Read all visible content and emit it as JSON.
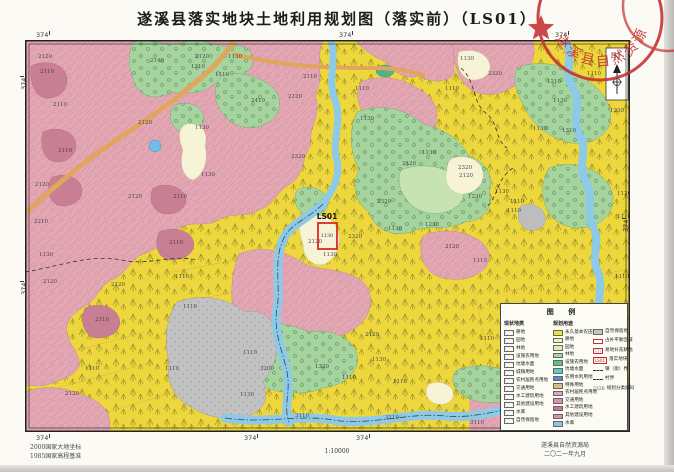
{
  "page": {
    "title": "遂溪县落实地块土地利用规划图（落实前）（LS01）"
  },
  "stamp": {
    "text": "遂溪县自然资源局",
    "color": "#c43030"
  },
  "north_arrow": {
    "label": "N"
  },
  "map": {
    "focus": {
      "label": "LS01",
      "code": "1130",
      "box": {
        "x": 293,
        "y": 183,
        "w": 19,
        "h": 26
      },
      "label_x": 302,
      "label_y": 179,
      "code_x": 302,
      "code_y": 197,
      "color": "#d42a2a"
    },
    "coordinate_labels": [
      {
        "text": "374",
        "x": 36,
        "y": 31,
        "rot": 0
      },
      {
        "text": "374",
        "x": 339,
        "y": 31,
        "rot": 0
      },
      {
        "text": "374",
        "x": 555,
        "y": 31,
        "rot": 0
      },
      {
        "text": "374",
        "x": 36,
        "y": 434,
        "rot": 0
      },
      {
        "text": "374",
        "x": 244,
        "y": 434,
        "rot": 0
      },
      {
        "text": "374",
        "x": 356,
        "y": 434,
        "rot": 0
      },
      {
        "text": "374",
        "x": 20,
        "y": 90,
        "rot": 1
      },
      {
        "text": "374",
        "x": 20,
        "y": 295,
        "rot": 1
      },
      {
        "text": "374",
        "x": 622,
        "y": 232,
        "rot": 1
      }
    ],
    "parcel_labels": [
      {
        "code": "2120",
        "x": 13,
        "y": 18
      },
      {
        "code": "2110",
        "x": 15,
        "y": 33
      },
      {
        "code": "2110",
        "x": 28,
        "y": 66
      },
      {
        "code": "2110",
        "x": 33,
        "y": 112
      },
      {
        "code": "2120",
        "x": 10,
        "y": 146
      },
      {
        "code": "2210",
        "x": 9,
        "y": 183
      },
      {
        "code": "1130",
        "x": 14,
        "y": 216
      },
      {
        "code": "2120",
        "x": 18,
        "y": 243
      },
      {
        "code": "2110",
        "x": 70,
        "y": 281
      },
      {
        "code": "2120",
        "x": 86,
        "y": 246
      },
      {
        "code": "2120",
        "x": 103,
        "y": 158
      },
      {
        "code": "2110",
        "x": 148,
        "y": 158
      },
      {
        "code": "2110",
        "x": 144,
        "y": 204
      },
      {
        "code": "2140",
        "x": 125,
        "y": 22
      },
      {
        "code": "1310",
        "x": 166,
        "y": 28
      },
      {
        "code": "1130",
        "x": 203,
        "y": 18
      },
      {
        "code": "1110",
        "x": 190,
        "y": 36
      },
      {
        "code": "2410",
        "x": 226,
        "y": 62
      },
      {
        "code": "2320",
        "x": 266,
        "y": 118
      },
      {
        "code": "2120",
        "x": 263,
        "y": 58
      },
      {
        "code": "2110",
        "x": 278,
        "y": 38
      },
      {
        "code": "1130",
        "x": 170,
        "y": 89
      },
      {
        "code": "1130",
        "x": 176,
        "y": 136
      },
      {
        "code": "1110",
        "x": 150,
        "y": 238
      },
      {
        "code": "1110",
        "x": 158,
        "y": 268
      },
      {
        "code": "2120",
        "x": 113,
        "y": 84
      },
      {
        "code": "2120",
        "x": 170,
        "y": 18
      },
      {
        "code": "2120",
        "x": 283,
        "y": 203
      },
      {
        "code": "2320",
        "x": 323,
        "y": 198
      },
      {
        "code": "1130",
        "x": 298,
        "y": 216
      },
      {
        "code": "2320",
        "x": 352,
        "y": 163
      },
      {
        "code": "2120",
        "x": 340,
        "y": 296
      },
      {
        "code": "3200",
        "x": 235,
        "y": 330
      },
      {
        "code": "3110",
        "x": 270,
        "y": 377
      },
      {
        "code": "3110",
        "x": 360,
        "y": 379
      },
      {
        "code": "3110",
        "x": 445,
        "y": 384
      },
      {
        "code": "1320",
        "x": 290,
        "y": 328
      },
      {
        "code": "1110",
        "x": 218,
        "y": 314
      },
      {
        "code": "1110",
        "x": 317,
        "y": 339
      },
      {
        "code": "1130",
        "x": 215,
        "y": 356
      },
      {
        "code": "1130",
        "x": 347,
        "y": 321
      },
      {
        "code": "1110",
        "x": 368,
        "y": 343
      },
      {
        "code": "1130",
        "x": 397,
        "y": 114
      },
      {
        "code": "2320",
        "x": 433,
        "y": 129
      },
      {
        "code": "2120",
        "x": 434,
        "y": 137
      },
      {
        "code": "1230",
        "x": 443,
        "y": 158
      },
      {
        "code": "1130",
        "x": 470,
        "y": 153
      },
      {
        "code": "1110",
        "x": 485,
        "y": 163
      },
      {
        "code": "1110",
        "x": 482,
        "y": 172
      },
      {
        "code": "1230",
        "x": 400,
        "y": 186
      },
      {
        "code": "2120",
        "x": 420,
        "y": 208
      },
      {
        "code": "1110",
        "x": 448,
        "y": 222
      },
      {
        "code": "2120",
        "x": 377,
        "y": 125
      },
      {
        "code": "1130",
        "x": 363,
        "y": 190
      },
      {
        "code": "1230",
        "x": 585,
        "y": 72
      },
      {
        "code": "1130",
        "x": 528,
        "y": 62
      },
      {
        "code": "1130",
        "x": 508,
        "y": 90
      },
      {
        "code": "1310",
        "x": 537,
        "y": 92
      },
      {
        "code": "1110",
        "x": 562,
        "y": 35
      },
      {
        "code": "1210",
        "x": 522,
        "y": 43
      },
      {
        "code": "1120",
        "x": 592,
        "y": 155
      },
      {
        "code": "1110",
        "x": 592,
        "y": 178
      },
      {
        "code": "1110",
        "x": 590,
        "y": 238
      },
      {
        "code": "1130",
        "x": 435,
        "y": 20
      },
      {
        "code": "2320",
        "x": 463,
        "y": 35
      },
      {
        "code": "1110",
        "x": 420,
        "y": 50
      },
      {
        "code": "1110",
        "x": 330,
        "y": 50
      },
      {
        "code": "1130",
        "x": 335,
        "y": 80
      },
      {
        "code": "1110",
        "x": 60,
        "y": 330
      },
      {
        "code": "2120",
        "x": 40,
        "y": 355
      },
      {
        "code": "1110",
        "x": 140,
        "y": 330
      },
      {
        "code": "1130",
        "x": 490,
        "y": 280
      },
      {
        "code": "1110",
        "x": 455,
        "y": 300
      }
    ]
  },
  "legend": {
    "title": "图 例",
    "col_current": {
      "header": "现状地类",
      "items": [
        "耕地",
        "园地",
        "林地",
        "设施农用地",
        "坑塘水面",
        "城镇用地",
        "农村居民点用地",
        "交通用地",
        "水工建筑用地",
        "其他建设用地",
        "水库",
        "自然保留地"
      ]
    },
    "col_planned": {
      "header": "规划用途",
      "items": [
        {
          "label": "永久基本农田",
          "color": "#f2e12f"
        },
        {
          "label": "耕地",
          "color": "#f5eeb5"
        },
        {
          "label": "园地",
          "color": "#dcedb6"
        },
        {
          "label": "林地",
          "color": "#9ed89a"
        },
        {
          "label": "设施农用地",
          "color": "#5fbf8f"
        },
        {
          "label": "坑塘水面",
          "color": "#5fc8c8"
        },
        {
          "label": "农用水利用地",
          "color": "#4f8fd0"
        },
        {
          "label": "特殊用地",
          "color": "#cfc08a"
        },
        {
          "label": "农村居民点用地",
          "color": "#e8a3ac"
        },
        {
          "label": "交通用地",
          "color": "#df8fb0"
        },
        {
          "label": "水工建筑用地",
          "color": "#d4718f"
        },
        {
          "label": "其他建设用地",
          "color": "#e08fa0"
        },
        {
          "label": "水库",
          "color": "#8fc4e4"
        }
      ]
    },
    "col_misc": {
      "items": [
        {
          "type": "gray",
          "label": "自然保留地"
        },
        {
          "type": "redbox",
          "label": "占补平衡区域"
        },
        {
          "type": "redfill",
          "label": "易地补充耕地"
        },
        {
          "type": "redtext",
          "symbol": "LS01",
          "label": "落实地块"
        },
        {
          "type": "dash",
          "label": "镇（街）界"
        },
        {
          "type": "dashdot",
          "label": "村界"
        },
        {
          "type": "code",
          "symbol": "2320",
          "label": "规划分类编码"
        }
      ]
    }
  },
  "footer": {
    "datum_line1": "2000国家大地坐标",
    "datum_line2": "1985国家高程基准",
    "scale": "1:10000",
    "agency": "遂溪县自然资源局",
    "date": "二〇二一年九月"
  },
  "colors": {
    "base_farmland_yellow": "#eed73d",
    "orchard_pink": "#e3a8b4",
    "village_rose": "#c87e93",
    "forest_green": "#a5d49e",
    "light_green": "#c8e3b2",
    "cream": "#f7f3d6",
    "river_blue": "#8ccae8",
    "road_orange": "#e2a55c",
    "transport_gray": "#c2c2c2",
    "seal_red": "#c43030"
  }
}
